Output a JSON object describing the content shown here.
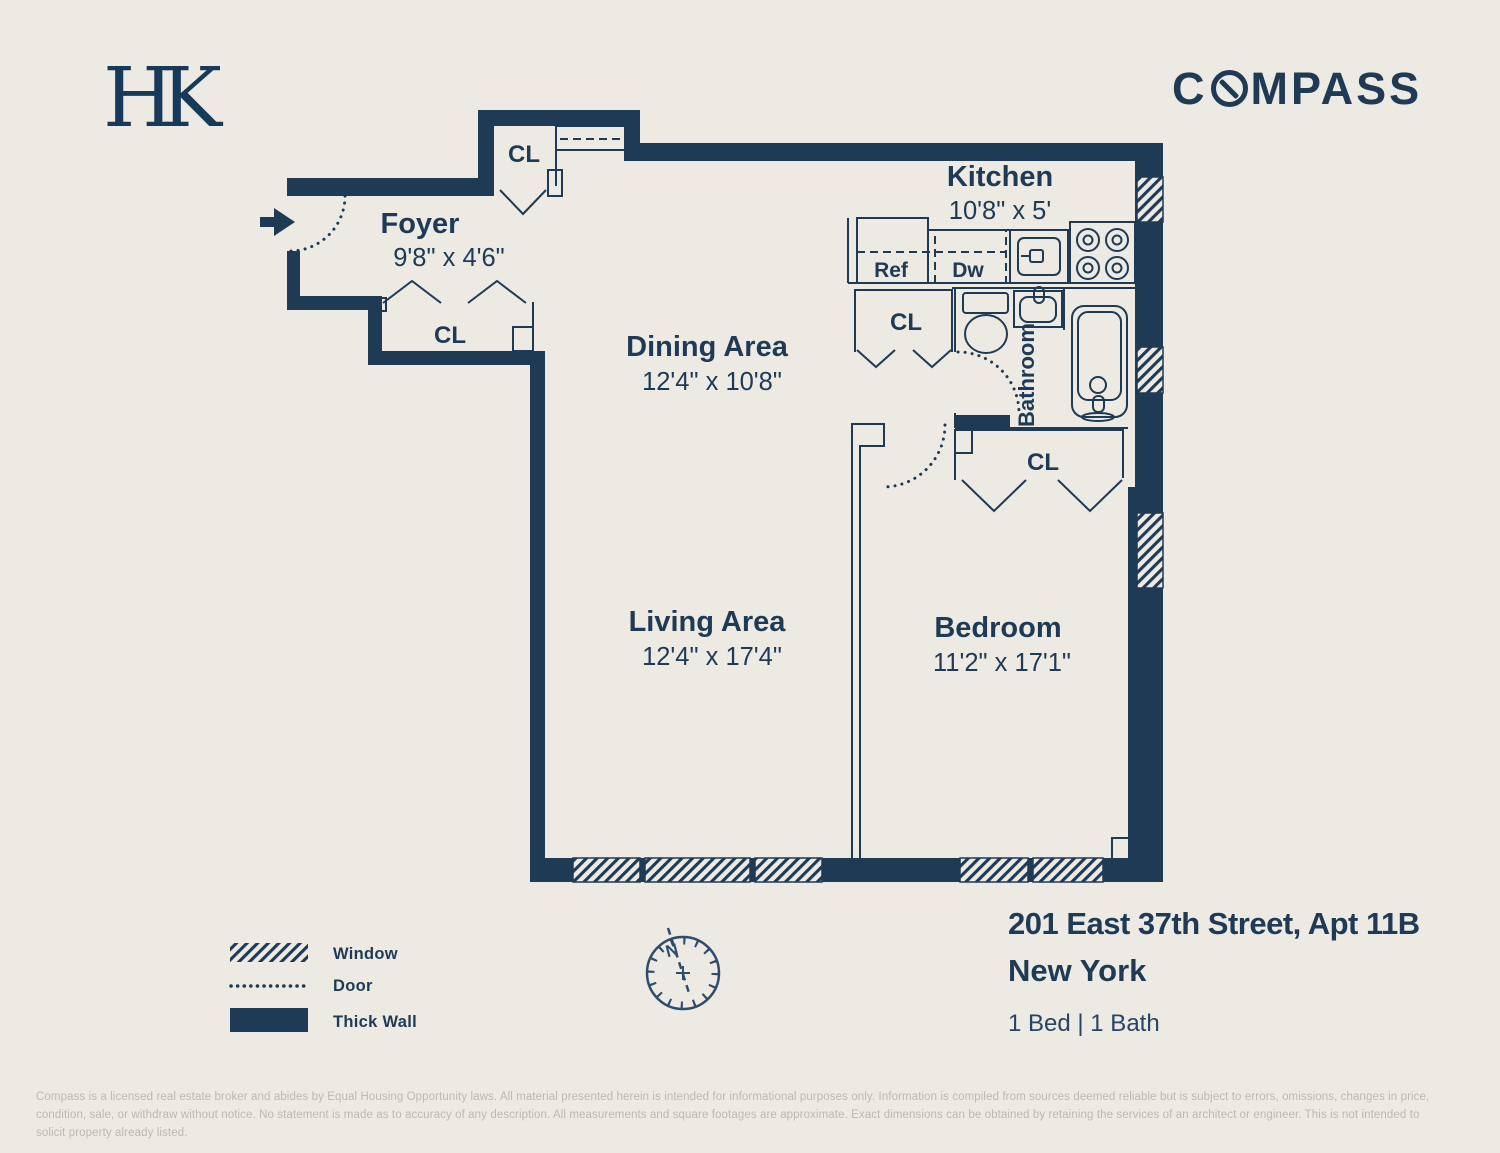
{
  "colors": {
    "background": "#edeae4",
    "ink": "#1e3a55",
    "disclaimer_gray": "#bcb8b2"
  },
  "branding": {
    "hk_logo_h": "H",
    "hk_logo_k": "K",
    "compass_logo_pre": "C",
    "compass_logo_post": "MPASS"
  },
  "plan": {
    "rooms": {
      "foyer": {
        "name": "Foyer",
        "dims": "9'8\" x 4'6\""
      },
      "dining": {
        "name": "Dining Area",
        "dims": "12'4\" x 10'8\""
      },
      "kitchen": {
        "name": "Kitchen",
        "dims": "10'8\" x 5'"
      },
      "living": {
        "name": "Living Area",
        "dims": "12'4\" x 17'4\""
      },
      "bedroom": {
        "name": "Bedroom",
        "dims": "11'2\" x 17'1\""
      },
      "bathroom": {
        "name": "Bathroom"
      }
    },
    "closet_label": "CL",
    "appliances": {
      "refrigerator": "Ref",
      "dishwasher": "Dw"
    },
    "compass_north": "N"
  },
  "legend": {
    "window": "Window",
    "door": "Door",
    "thick_wall": "Thick Wall"
  },
  "listing": {
    "address": "201 East 37th Street, Apt 11B",
    "city": "New York",
    "beds_baths": "1 Bed | 1 Bath"
  },
  "disclaimer": "Compass is a licensed real estate broker and abides by Equal Housing Opportunity laws. All material presented herein is intended for informational purposes only. Information is compiled from sources deemed reliable but is subject to errors, omissions, changes in price, condition, sale, or withdraw without notice. No statement is made as to accuracy of any description. All measurements and square footages are approximate. Exact dimensions can be obtained by retaining the services of an architect or engineer. This is not intended to solicit property already listed."
}
